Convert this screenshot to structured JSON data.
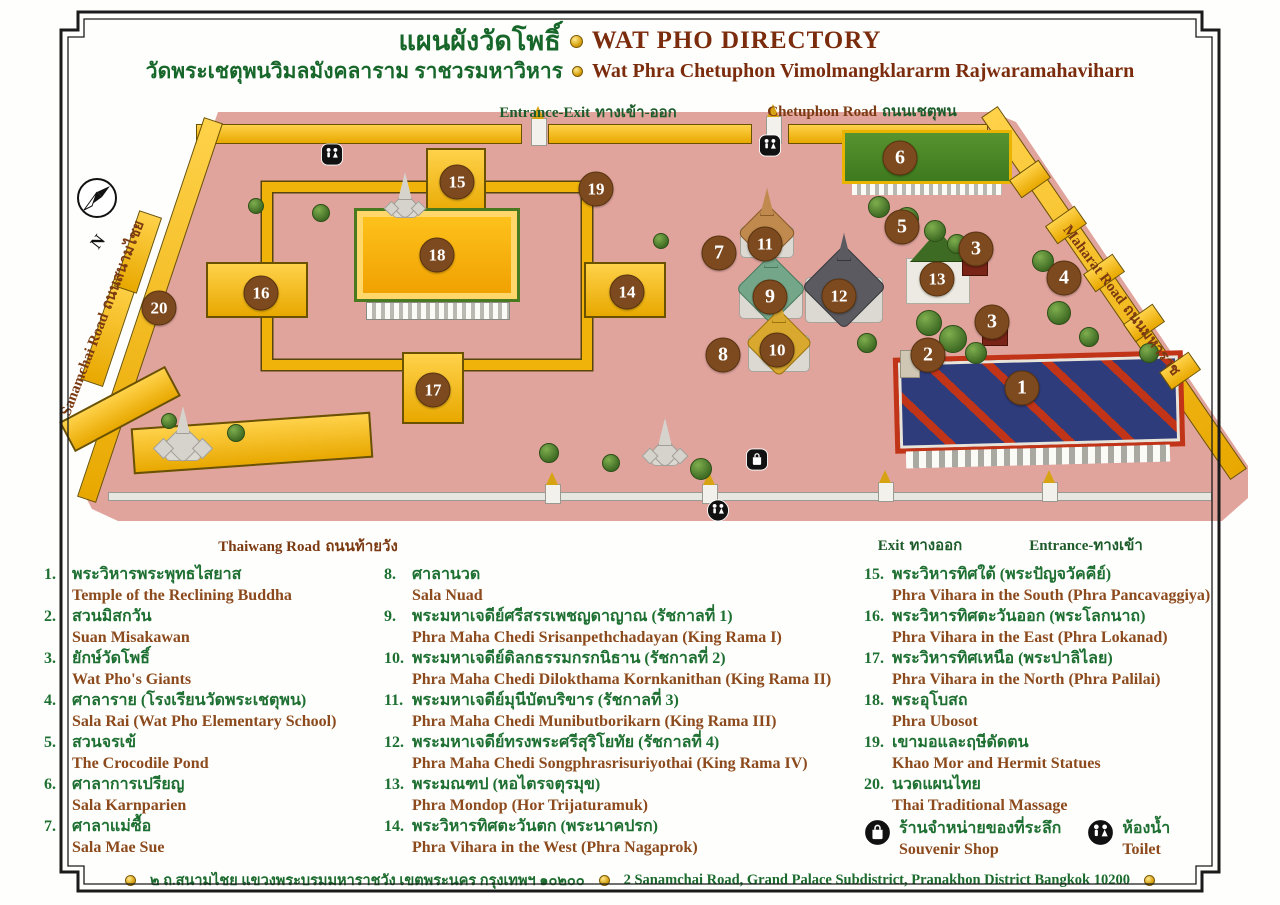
{
  "title": {
    "thai": "แผนผังวัดโพธิ์",
    "english": "WAT PHO DIRECTORY",
    "sub_thai": "วัดพระเชตุพนวิมลมังคลาราม ราชวรมหาวิหาร",
    "sub_english": "Wat Phra Chetuphon Vimolmangklararm Rajwaramahaviharn"
  },
  "map": {
    "compass_label": "N",
    "road_labels": [
      {
        "id": "entrance-exit-top",
        "english": "Entrance-Exit",
        "thai": "ทางเข้า-ออก",
        "x": 588,
        "y": 112,
        "rotate": 0,
        "style": "green",
        "tight": false
      },
      {
        "id": "chetuphon-road",
        "english": "Chetuphon Road",
        "thai": "ถนนเชตุพน",
        "x": 862,
        "y": 111,
        "rotate": 0,
        "style": "mixed",
        "tight": false
      },
      {
        "id": "thaiwang-road",
        "english": "Thaiwang Road",
        "thai": "ถนนท้ายวัง",
        "x": 308,
        "y": 546,
        "rotate": 0,
        "style": "brown",
        "tight": false
      },
      {
        "id": "exit-bottom",
        "english": "Exit",
        "thai": "ทางออก",
        "x": 920,
        "y": 545,
        "rotate": 0,
        "style": "green",
        "tight": false
      },
      {
        "id": "entrance-bottom",
        "english": "Entrance-",
        "thai": "ทางเข้า",
        "x": 1086,
        "y": 545,
        "rotate": 0,
        "style": "green",
        "tight": true
      },
      {
        "id": "sanamchai-road",
        "english": "Sanamchai Road",
        "thai": "ถนนสนามไชย",
        "x": 102,
        "y": 318,
        "rotate": -69,
        "style": "brown",
        "tight": false
      },
      {
        "id": "maharat-road",
        "english": "Maharat Road",
        "thai": "ถนนมหาราช",
        "x": 1122,
        "y": 300,
        "rotate": 53,
        "style": "brown",
        "tight": false
      }
    ],
    "markers": [
      {
        "n": "1",
        "x": 1022,
        "y": 388
      },
      {
        "n": "2",
        "x": 928,
        "y": 355
      },
      {
        "n": "3",
        "x": 976,
        "y": 249
      },
      {
        "n": "3",
        "x": 992,
        "y": 322
      },
      {
        "n": "4",
        "x": 1064,
        "y": 278
      },
      {
        "n": "5",
        "x": 902,
        "y": 227
      },
      {
        "n": "6",
        "x": 900,
        "y": 158
      },
      {
        "n": "7",
        "x": 719,
        "y": 253
      },
      {
        "n": "8",
        "x": 723,
        "y": 355
      },
      {
        "n": "9",
        "x": 770,
        "y": 297
      },
      {
        "n": "10",
        "x": 777,
        "y": 350
      },
      {
        "n": "11",
        "x": 765,
        "y": 244
      },
      {
        "n": "12",
        "x": 839,
        "y": 296
      },
      {
        "n": "13",
        "x": 937,
        "y": 279
      },
      {
        "n": "14",
        "x": 627,
        "y": 292
      },
      {
        "n": "15",
        "x": 457,
        "y": 182
      },
      {
        "n": "16",
        "x": 261,
        "y": 293
      },
      {
        "n": "17",
        "x": 433,
        "y": 390
      },
      {
        "n": "18",
        "x": 437,
        "y": 255
      },
      {
        "n": "19",
        "x": 596,
        "y": 189
      },
      {
        "n": "20",
        "x": 159,
        "y": 308
      }
    ],
    "amenities": [
      {
        "type": "toilet",
        "x": 332,
        "y": 157,
        "shape": "square"
      },
      {
        "type": "toilet",
        "x": 770,
        "y": 148,
        "shape": "square"
      },
      {
        "type": "toilet",
        "x": 718,
        "y": 513,
        "shape": "circle"
      },
      {
        "type": "souvenir",
        "x": 757,
        "y": 462,
        "shape": "square"
      }
    ]
  },
  "legend": {
    "columns": [
      [
        {
          "n": "1.",
          "thai": "พระวิหารพระพุทธไสยาส",
          "english": "Temple of the Reclining Buddha"
        },
        {
          "n": "2.",
          "thai": "สวนมิสกวัน",
          "english": "Suan Misakawan"
        },
        {
          "n": "3.",
          "thai": "ยักษ์วัดโพธิ์",
          "english": "Wat Pho's Giants"
        },
        {
          "n": "4.",
          "thai": "ศาลาราย (โรงเรียนวัดพระเชตุพน)",
          "english": "Sala Rai (Wat Pho Elementary School)"
        },
        {
          "n": "5.",
          "thai": "สวนจรเข้",
          "english": "The Crocodile Pond"
        },
        {
          "n": "6.",
          "thai": "ศาลาการเปรียญ",
          "english": "Sala Karnparien"
        },
        {
          "n": "7.",
          "thai": "ศาลาแม่ซื้อ",
          "english": "Sala Mae Sue"
        }
      ],
      [
        {
          "n": "8.",
          "thai": "ศาลานวด",
          "english": "Sala Nuad"
        },
        {
          "n": "9.",
          "thai": "พระมหาเจดีย์ศรีสรรเพชญดาญาณ (รัชกาลที่ 1)",
          "english": "Phra Maha Chedi Srisanpethchadayan (King Rama I)"
        },
        {
          "n": "10.",
          "thai": "พระมหาเจดีย์ดิลกธรรมกรกนิธาน (รัชกาลที่ 2)",
          "english": "Phra Maha Chedi Dilokthama Kornkanithan (King Rama II)"
        },
        {
          "n": "11.",
          "thai": "พระมหาเจดีย์มุนีบัตบริขาร (รัชกาลที่ 3)",
          "english": "Phra Maha Chedi Munibutborikarn (King Rama III)"
        },
        {
          "n": "12.",
          "thai": "พระมหาเจดีย์ทรงพระศรีสุริโยทัย (รัชกาลที่ 4)",
          "english": "Phra Maha Chedi Songphrasrisuriyothai (King Rama IV)"
        },
        {
          "n": "13.",
          "thai": "พระมณฑป (หอไตรจตุรมุข)",
          "english": "Phra Mondop (Hor Trijaturamuk)"
        },
        {
          "n": "14.",
          "thai": "พระวิหารทิศตะวันตก (พระนาคปรก)",
          "english": "Phra Vihara in the West (Phra Nagaprok)"
        }
      ],
      [
        {
          "n": "15.",
          "thai": "พระวิหารทิศใต้ (พระปัญจวัคคีย์)",
          "english": "Phra Vihara in the South (Phra Pancavaggiya)"
        },
        {
          "n": "16.",
          "thai": "พระวิหารทิศตะวันออก (พระโลกนาถ)",
          "english": "Phra Vihara in the East (Phra Lokanad)"
        },
        {
          "n": "17.",
          "thai": "พระวิหารทิศเหนือ (พระปาลิไลย)",
          "english": "Phra Vihara in the North (Phra Palilai)"
        },
        {
          "n": "18.",
          "thai": "พระอุโบสถ",
          "english": "Phra Ubosot"
        },
        {
          "n": "19.",
          "thai": "เขามอและฤษีดัดตน",
          "english": "Khao Mor and Hermit Statues"
        },
        {
          "n": "20.",
          "thai": "นวดแผนไทย",
          "english": "Thai Traditional Massage"
        }
      ]
    ],
    "amenity_items": [
      {
        "type": "souvenir",
        "thai": "ร้านจำหน่ายของที่ระลึก",
        "english": "Souvenir Shop"
      },
      {
        "type": "toilet",
        "thai": "ห้องน้ำ",
        "english": "Toilet"
      }
    ]
  },
  "footer": {
    "thai": "๒ ถ.สนามไชย แขวงพระบรมมหาราชวัง เขตพระนคร กรุงเทพฯ ๑๐๒๐๐",
    "english": "2 Sanamchai Road, Grand Palace Subdistrict, Pranakhon District Bangkok 10200"
  },
  "colors": {
    "ground_pink": "#e1a49d",
    "thai_green": "#1e7032",
    "english_brown": "#8c4a1d",
    "title_maroon": "#7b2c0d",
    "marker_brown": "#7d4a1f",
    "roof_yellow": "#f0b30a",
    "roof_green": "#3f7d26",
    "roof_blue": "#2f3c7c",
    "trim_red": "#c23418",
    "gold": "#d8a312"
  }
}
